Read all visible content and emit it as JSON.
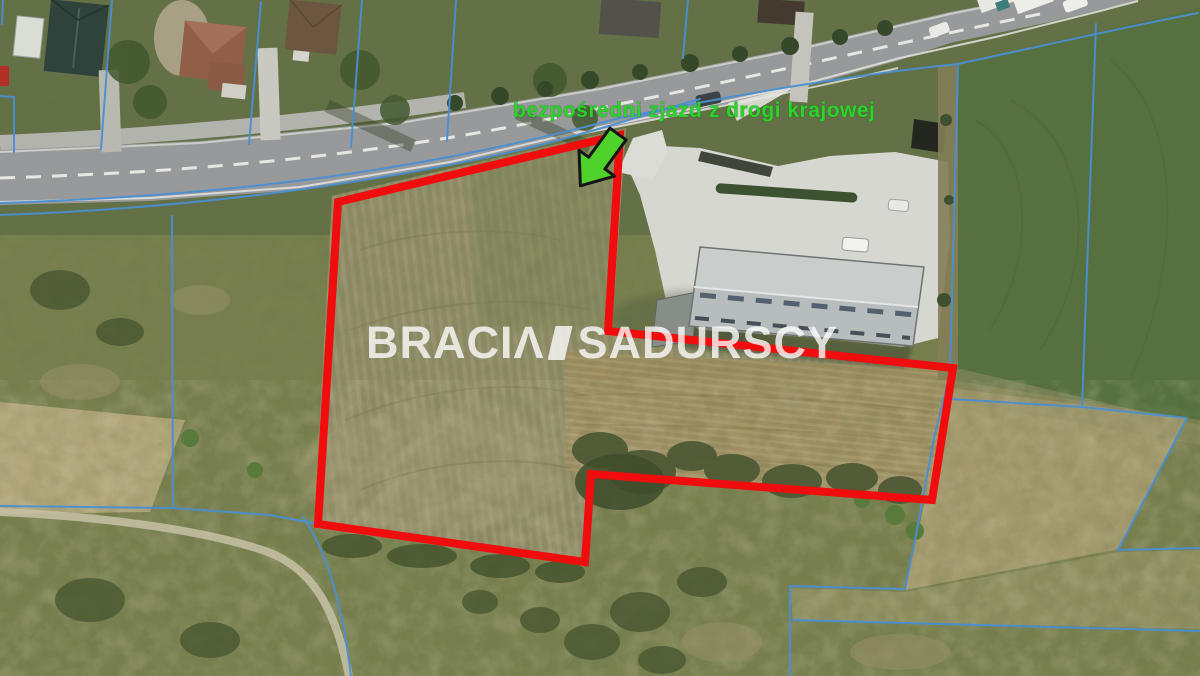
{
  "annotation": {
    "label": "bezpośredni zjazd z drogi krajowej",
    "color": "#2bd32b"
  },
  "watermark": {
    "part1": "BRACIΛ",
    "part2": "SADURSCY"
  },
  "legend": {
    "image_type": "aerial photo",
    "plot_outline_color": "#f10d0d",
    "cadastral_line_color": "#4a8fd3",
    "arrow_color": "#4fd32c",
    "annotation_color": "#2bd32b"
  }
}
